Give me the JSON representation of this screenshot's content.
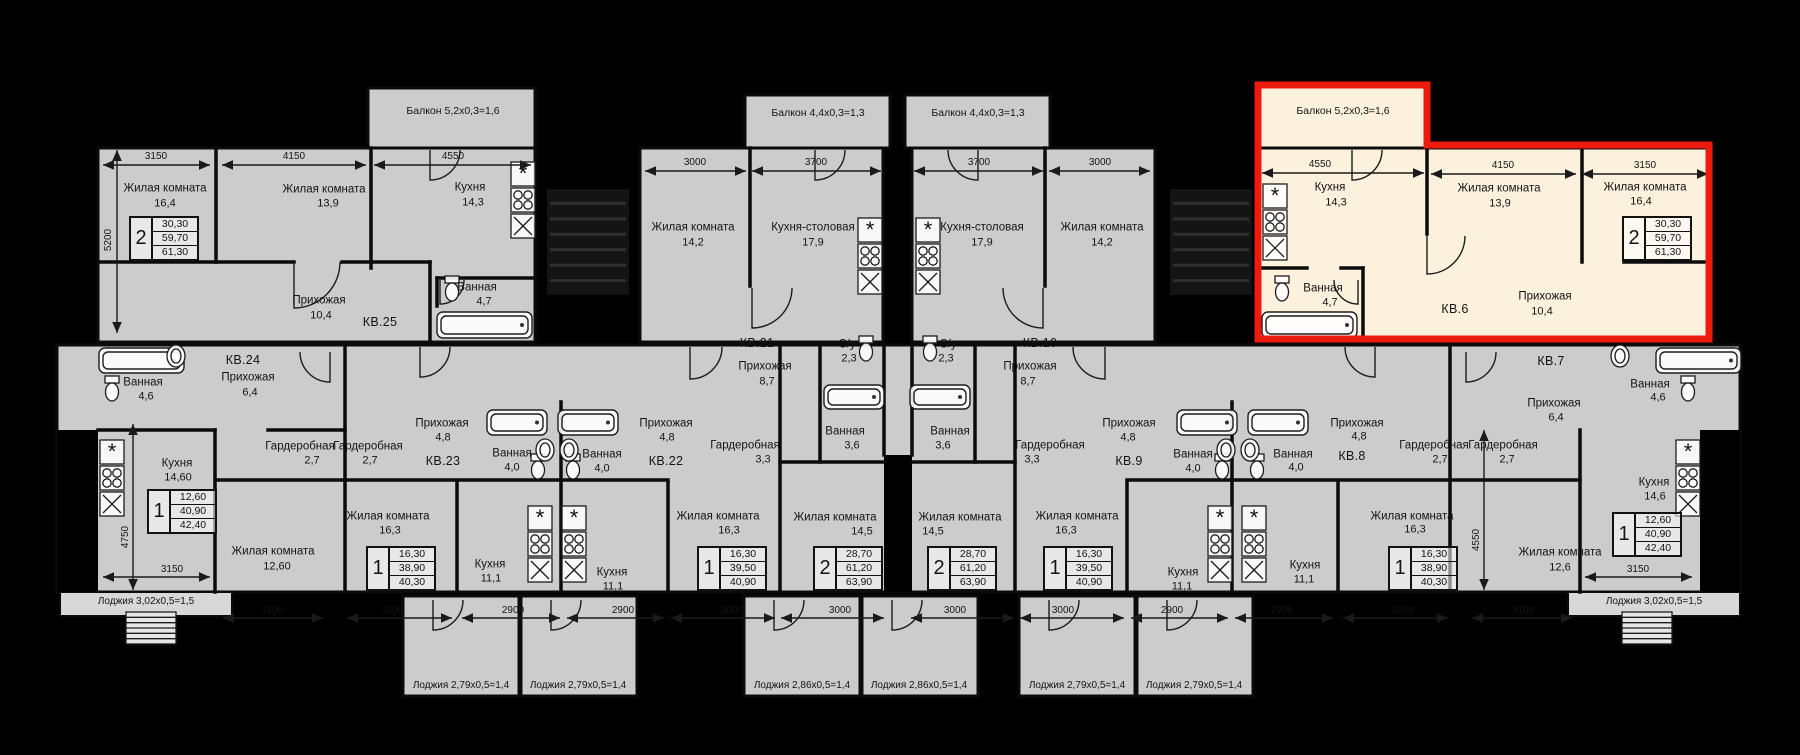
{
  "palette": {
    "background": "#000000",
    "slab": "#cccccc",
    "slab_light": "#d8d8d8",
    "wall": "#0b0b0b",
    "text": "#141414",
    "highlight_fill": "#fcf1dd",
    "highlight_stroke": "#ef1a0e",
    "fixture": "#1c1c1c"
  },
  "selected_apartment": "КВ.6",
  "apartments": [
    {
      "key": "kv25",
      "number": "КВ.25",
      "number_pos": [
        380,
        322
      ],
      "highlighted": false,
      "balcony": {
        "t": "Балкон 5,2х0,3=1,6",
        "x": 453,
        "y": 111
      },
      "table": {
        "digit": "2",
        "values": [
          "30,30",
          "59,70",
          "61,30"
        ],
        "x": 129,
        "y": 216
      },
      "rooms": [
        [
          "Жилая комната",
          "16,4",
          165,
          189,
          165,
          204
        ],
        [
          "Жилая комната",
          "13,9",
          324,
          190,
          328,
          204
        ],
        [
          "Кухня",
          "14,3",
          470,
          188,
          473,
          203
        ],
        [
          "Прихожая",
          "10,4",
          319,
          301,
          321,
          316
        ],
        [
          "Ванная",
          "4,7",
          477,
          288,
          484,
          302
        ]
      ]
    },
    {
      "key": "kv24",
      "number": "КВ.24",
      "number_pos": [
        243,
        360
      ],
      "highlighted": false,
      "table": {
        "digit": "1",
        "values": [
          "12,60",
          "40,90",
          "42,40"
        ],
        "x": 147,
        "y": 489
      },
      "rooms": [
        [
          "Ванная",
          "4,6",
          143,
          383,
          146,
          397
        ],
        [
          "Прихожая",
          "6,4",
          248,
          378,
          250,
          393
        ],
        [
          "Гардеробная",
          "2,7",
          300,
          447,
          312,
          461
        ],
        [
          "Кухня",
          "14,60",
          177,
          464,
          178,
          478
        ],
        [
          "Жилая комната",
          "12,60",
          273,
          552,
          277,
          567
        ]
      ]
    },
    {
      "key": "kv23",
      "number": "КВ.23",
      "number_pos": [
        443,
        461
      ],
      "highlighted": false,
      "table": {
        "digit": "1",
        "values": [
          "16,30",
          "38,90",
          "40,30"
        ],
        "x": 366,
        "y": 546
      },
      "rooms": [
        [
          "Гардеробная",
          "2,7",
          368,
          447,
          370,
          461
        ],
        [
          "Прихожая",
          "4,8",
          442,
          424,
          443,
          438
        ],
        [
          "Ванная",
          "4,0",
          512,
          454,
          512,
          468
        ],
        [
          "Жилая комната",
          "16,3",
          388,
          517,
          390,
          531
        ],
        [
          "Кухня",
          "11,1",
          490,
          565,
          491,
          579
        ]
      ]
    },
    {
      "key": "kv22",
      "number": "КВ.22",
      "number_pos": [
        666,
        461
      ],
      "highlighted": false,
      "table": {
        "digit": "1",
        "values": [
          "16,30",
          "39,50",
          "40,90"
        ],
        "x": 697,
        "y": 546
      },
      "rooms": [
        [
          "Прихожая",
          "4,8",
          666,
          424,
          667,
          438
        ],
        [
          "Ванная",
          "4,0",
          602,
          455,
          602,
          469
        ],
        [
          "Гардеробная",
          "3,3",
          745,
          446,
          763,
          460
        ],
        [
          "Жилая комната",
          "16,3",
          718,
          517,
          729,
          531
        ],
        [
          "Кухня",
          "11,1",
          612,
          573,
          613,
          587
        ]
      ]
    },
    {
      "key": "kv21",
      "number": "КВ.21",
      "number_pos": [
        757,
        343
      ],
      "highlighted": false,
      "balcony": {
        "t": "Балкон 4,4х0,3=1,3",
        "x": 818,
        "y": 113
      },
      "table": {
        "digit": "2",
        "values": [
          "28,70",
          "61,20",
          "63,90"
        ],
        "x": 813,
        "y": 546
      },
      "rooms": [
        [
          "Жилая комната",
          "14,2",
          693,
          228,
          693,
          243
        ],
        [
          "Кухня-столовая",
          "17,9",
          813,
          228,
          813,
          243
        ],
        [
          "Прихожая",
          "8,7",
          765,
          367,
          767,
          382
        ],
        [
          "С/у",
          "2,3",
          847,
          345,
          849,
          359
        ],
        [
          "Ванная",
          "3,6",
          845,
          432,
          852,
          446
        ],
        [
          "Жилая комната",
          "14,5",
          835,
          518,
          862,
          532
        ]
      ]
    },
    {
      "key": "kv10",
      "number": "КВ.10",
      "number_pos": [
        1040,
        343
      ],
      "highlighted": false,
      "balcony": {
        "t": "Балкон 4,4х0,3=1,3",
        "x": 978,
        "y": 113
      },
      "table": {
        "digit": "2",
        "values": [
          "28,70",
          "61,20",
          "63,90"
        ],
        "x": 927,
        "y": 546
      },
      "rooms": [
        [
          "Кухня-столовая",
          "17,9",
          982,
          228,
          982,
          243
        ],
        [
          "Жилая комната",
          "14,2",
          1102,
          228,
          1102,
          243
        ],
        [
          "Прихожая",
          "8,7",
          1030,
          367,
          1028,
          382
        ],
        [
          "С/у",
          "2,3",
          948,
          345,
          946,
          359
        ],
        [
          "Ванная",
          "3,6",
          950,
          432,
          943,
          446
        ],
        [
          "Жилая комната",
          "14,5",
          960,
          518,
          933,
          532
        ]
      ]
    },
    {
      "key": "kv9",
      "number": "КВ.9",
      "number_pos": [
        1129,
        461
      ],
      "highlighted": false,
      "table": {
        "digit": "1",
        "values": [
          "16,30",
          "39,50",
          "40,90"
        ],
        "x": 1043,
        "y": 546
      },
      "rooms": [
        [
          "Прихожая",
          "4,8",
          1129,
          424,
          1128,
          438
        ],
        [
          "Ванная",
          "4,0",
          1193,
          455,
          1193,
          469
        ],
        [
          "Гардеробная",
          "3,3",
          1050,
          446,
          1032,
          460
        ],
        [
          "Жилая комната",
          "16,3",
          1077,
          517,
          1066,
          531
        ],
        [
          "Кухня",
          "11,1",
          1183,
          573,
          1182,
          587
        ]
      ]
    },
    {
      "key": "kv8",
      "number": "КВ.8",
      "number_pos": [
        1352,
        456
      ],
      "highlighted": false,
      "table": {
        "digit": "1",
        "values": [
          "16,30",
          "38,90",
          "40,30"
        ],
        "x": 1388,
        "y": 546
      },
      "rooms": [
        [
          "Прихожая",
          "4,8",
          1357,
          424,
          1359,
          437
        ],
        [
          "Гардеробная",
          "2,7",
          1434,
          446,
          1440,
          460
        ],
        [
          "Ванная",
          "4,0",
          1293,
          455,
          1296,
          468
        ],
        [
          "Жилая комната",
          "16,3",
          1412,
          517,
          1415,
          530
        ],
        [
          "Кухня",
          "11,1",
          1305,
          566,
          1304,
          580
        ]
      ]
    },
    {
      "key": "kv7",
      "number": "КВ.7",
      "number_pos": [
        1551,
        361
      ],
      "highlighted": false,
      "table": {
        "digit": "1",
        "values": [
          "12,60",
          "40,90",
          "42,40"
        ],
        "x": 1612,
        "y": 512
      },
      "rooms": [
        [
          "Ванная",
          "4,6",
          1650,
          385,
          1658,
          398
        ],
        [
          "Прихожая",
          "6,4",
          1554,
          404,
          1556,
          418
        ],
        [
          "Гардеробная",
          "2,7",
          1503,
          446,
          1507,
          460
        ],
        [
          "Кухня",
          "14,6",
          1654,
          483,
          1655,
          497
        ],
        [
          "Жилая комната",
          "12,6",
          1560,
          553,
          1560,
          568
        ]
      ]
    },
    {
      "key": "kv6",
      "number": "КВ.6",
      "number_pos": [
        1455,
        309
      ],
      "highlighted": true,
      "balcony": {
        "t": "Балкон 5,2х0,3=1,6",
        "x": 1343,
        "y": 111
      },
      "table": {
        "digit": "2",
        "values": [
          "30,30",
          "59,70",
          "61,30"
        ],
        "x": 1622,
        "y": 216
      },
      "rooms": [
        [
          "Кухня",
          "14,3",
          1330,
          188,
          1336,
          203
        ],
        [
          "Жилая комната",
          "13,9",
          1499,
          189,
          1500,
          204
        ],
        [
          "Жилая комната",
          "16,4",
          1645,
          188,
          1641,
          202
        ],
        [
          "Прихожая",
          "10,4",
          1545,
          297,
          1542,
          312
        ],
        [
          "Ванная",
          "4,7",
          1323,
          289,
          1330,
          303
        ]
      ]
    }
  ],
  "dimensions": [
    {
      "t": "3150",
      "x": 156,
      "y": 157,
      "a": [
        103,
        165,
        210,
        165
      ]
    },
    {
      "t": "4150",
      "x": 294,
      "y": 157,
      "a": [
        222,
        165,
        366,
        165
      ]
    },
    {
      "t": "4550",
      "x": 453,
      "y": 157,
      "a": [
        374,
        165,
        531,
        165
      ]
    },
    {
      "t": "3000",
      "x": 695,
      "y": 163,
      "a": [
        645,
        171,
        746,
        171
      ]
    },
    {
      "t": "3700",
      "x": 816,
      "y": 163,
      "a": [
        752,
        171,
        881,
        171
      ]
    },
    {
      "t": "3700",
      "x": 979,
      "y": 163,
      "a": [
        914,
        171,
        1043,
        171
      ]
    },
    {
      "t": "3000",
      "x": 1100,
      "y": 163,
      "a": [
        1049,
        171,
        1150,
        171
      ]
    },
    {
      "t": "4550",
      "x": 1320,
      "y": 165,
      "a": [
        1262,
        173,
        1424,
        173
      ]
    },
    {
      "t": "4150",
      "x": 1503,
      "y": 166,
      "a": [
        1431,
        174,
        1576,
        174
      ]
    },
    {
      "t": "3150",
      "x": 1645,
      "y": 166,
      "a": [
        1582,
        174,
        1708,
        174
      ]
    },
    {
      "t": "5200",
      "x": 109,
      "y": 240,
      "a": [
        117,
        150,
        117,
        333
      ],
      "r": 1
    },
    {
      "t": "4750",
      "x": 126,
      "y": 537,
      "a": [
        133,
        424,
        133,
        590
      ],
      "r": 1
    },
    {
      "t": "4550",
      "x": 1477,
      "y": 540,
      "a": [
        1484,
        430,
        1484,
        590
      ],
      "r": 1
    },
    {
      "t": "3150",
      "x": 172,
      "y": 570,
      "a": [
        103,
        577,
        210,
        577
      ]
    },
    {
      "t": "3100",
      "x": 272,
      "y": 611,
      "a": [
        223,
        618,
        323,
        618
      ]
    },
    {
      "t": "3200",
      "x": 392,
      "y": 611,
      "a": [
        347,
        618,
        452,
        618
      ]
    },
    {
      "t": "2900",
      "x": 513,
      "y": 611,
      "a": [
        462,
        618,
        560,
        618
      ]
    },
    {
      "t": "2900",
      "x": 623,
      "y": 611,
      "a": [
        567,
        618,
        664,
        618
      ]
    },
    {
      "t": "3000",
      "x": 732,
      "y": 611,
      "a": [
        671,
        618,
        775,
        618
      ]
    },
    {
      "t": "3000",
      "x": 840,
      "y": 611,
      "a": [
        781,
        618,
        884,
        618
      ]
    },
    {
      "t": "3000",
      "x": 955,
      "y": 611,
      "a": [
        911,
        618,
        1014,
        618
      ]
    },
    {
      "t": "3000",
      "x": 1063,
      "y": 611,
      "a": [
        1020,
        618,
        1124,
        618
      ]
    },
    {
      "t": "2900",
      "x": 1172,
      "y": 611,
      "a": [
        1131,
        618,
        1228,
        618
      ]
    },
    {
      "t": "2900",
      "x": 1282,
      "y": 611,
      "a": [
        1235,
        618,
        1333,
        618
      ]
    },
    {
      "t": "3200",
      "x": 1403,
      "y": 611,
      "a": [
        1343,
        618,
        1448,
        618
      ]
    },
    {
      "t": "3100",
      "x": 1523,
      "y": 611,
      "a": [
        1472,
        618,
        1572,
        618
      ]
    },
    {
      "t": "3150",
      "x": 1638,
      "y": 570,
      "a": [
        1585,
        577,
        1692,
        577
      ]
    }
  ],
  "loggias": [
    [
      "Лоджия 3,02х0,5=1,5",
      146,
      602
    ],
    [
      "Лоджия 2,79х0,5=1,4",
      461,
      686
    ],
    [
      "Лоджия 2,79х0,5=1,4",
      578,
      686
    ],
    [
      "Лоджия 2,86х0,5=1,4",
      802,
      686
    ],
    [
      "Лоджия 2,86х0,5=1,4",
      919,
      686
    ],
    [
      "Лоджия 2,79х0,5=1,4",
      1077,
      686
    ],
    [
      "Лоджия 2,79х0,5=1,4",
      1194,
      686
    ],
    [
      "Лоджия 3,02х0,5=1,5",
      1654,
      602
    ]
  ]
}
